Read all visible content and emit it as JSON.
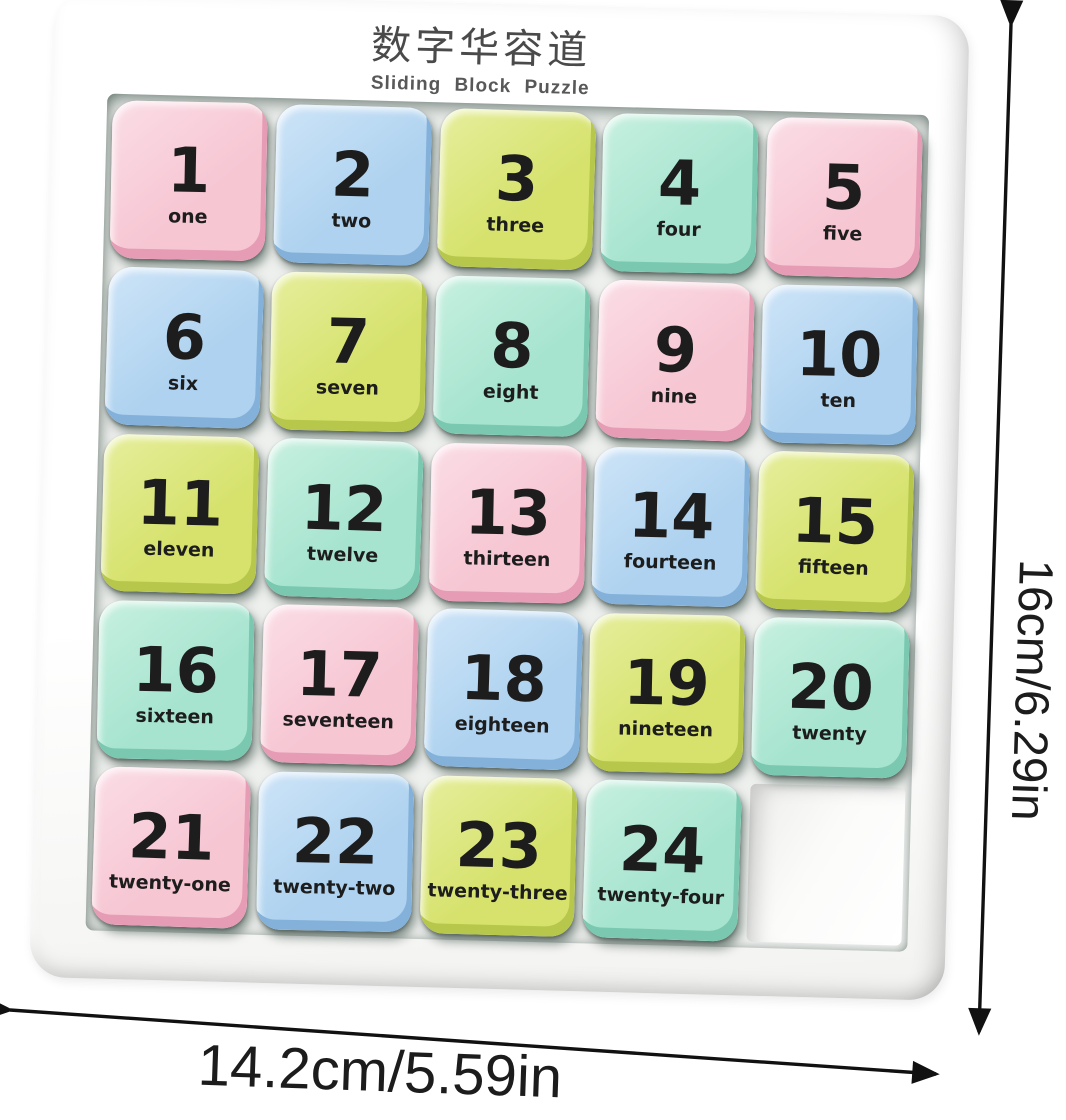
{
  "title": {
    "chinese": "数字华容道",
    "english": "Sliding Block Puzzle"
  },
  "board": {
    "rows": 5,
    "cols": 5,
    "empty_position": 25,
    "tiles": [
      {
        "number": "1",
        "word": "one",
        "color": "pink"
      },
      {
        "number": "2",
        "word": "two",
        "color": "blue"
      },
      {
        "number": "3",
        "word": "three",
        "color": "green"
      },
      {
        "number": "4",
        "word": "four",
        "color": "mint"
      },
      {
        "number": "5",
        "word": "five",
        "color": "pink"
      },
      {
        "number": "6",
        "word": "six",
        "color": "blue"
      },
      {
        "number": "7",
        "word": "seven",
        "color": "green"
      },
      {
        "number": "8",
        "word": "eight",
        "color": "mint"
      },
      {
        "number": "9",
        "word": "nine",
        "color": "pink"
      },
      {
        "number": "10",
        "word": "ten",
        "color": "blue"
      },
      {
        "number": "11",
        "word": "eleven",
        "color": "green"
      },
      {
        "number": "12",
        "word": "twelve",
        "color": "mint"
      },
      {
        "number": "13",
        "word": "thirteen",
        "color": "pink"
      },
      {
        "number": "14",
        "word": "fourteen",
        "color": "blue"
      },
      {
        "number": "15",
        "word": "fifteen",
        "color": "green"
      },
      {
        "number": "16",
        "word": "sixteen",
        "color": "mint"
      },
      {
        "number": "17",
        "word": "seventeen",
        "color": "pink"
      },
      {
        "number": "18",
        "word": "eighteen",
        "color": "blue"
      },
      {
        "number": "19",
        "word": "nineteen",
        "color": "green"
      },
      {
        "number": "20",
        "word": "twenty",
        "color": "mint"
      },
      {
        "number": "21",
        "word": "twenty-one",
        "color": "pink"
      },
      {
        "number": "22",
        "word": "twenty-two",
        "color": "blue"
      },
      {
        "number": "23",
        "word": "twenty-three",
        "color": "green"
      },
      {
        "number": "24",
        "word": "twenty-four",
        "color": "mint"
      }
    ]
  },
  "palette": {
    "pink": {
      "face": "#f6c6d3",
      "light": "#fbdde6",
      "edge": "#e59cb4"
    },
    "blue": {
      "face": "#aed2ef",
      "light": "#cde4f8",
      "edge": "#84b1d9"
    },
    "green": {
      "face": "#d6e26c",
      "light": "#e6ee9c",
      "edge": "#b6c74c"
    },
    "mint": {
      "face": "#a6e4cf",
      "light": "#c7f0e0",
      "edge": "#7ac8b0"
    },
    "number_color": "#1d1d1d",
    "frame_color": "#ffffff"
  },
  "annotations": {
    "height_label": "16cm/6.29in",
    "width_label": "14.2cm/5.59in"
  }
}
